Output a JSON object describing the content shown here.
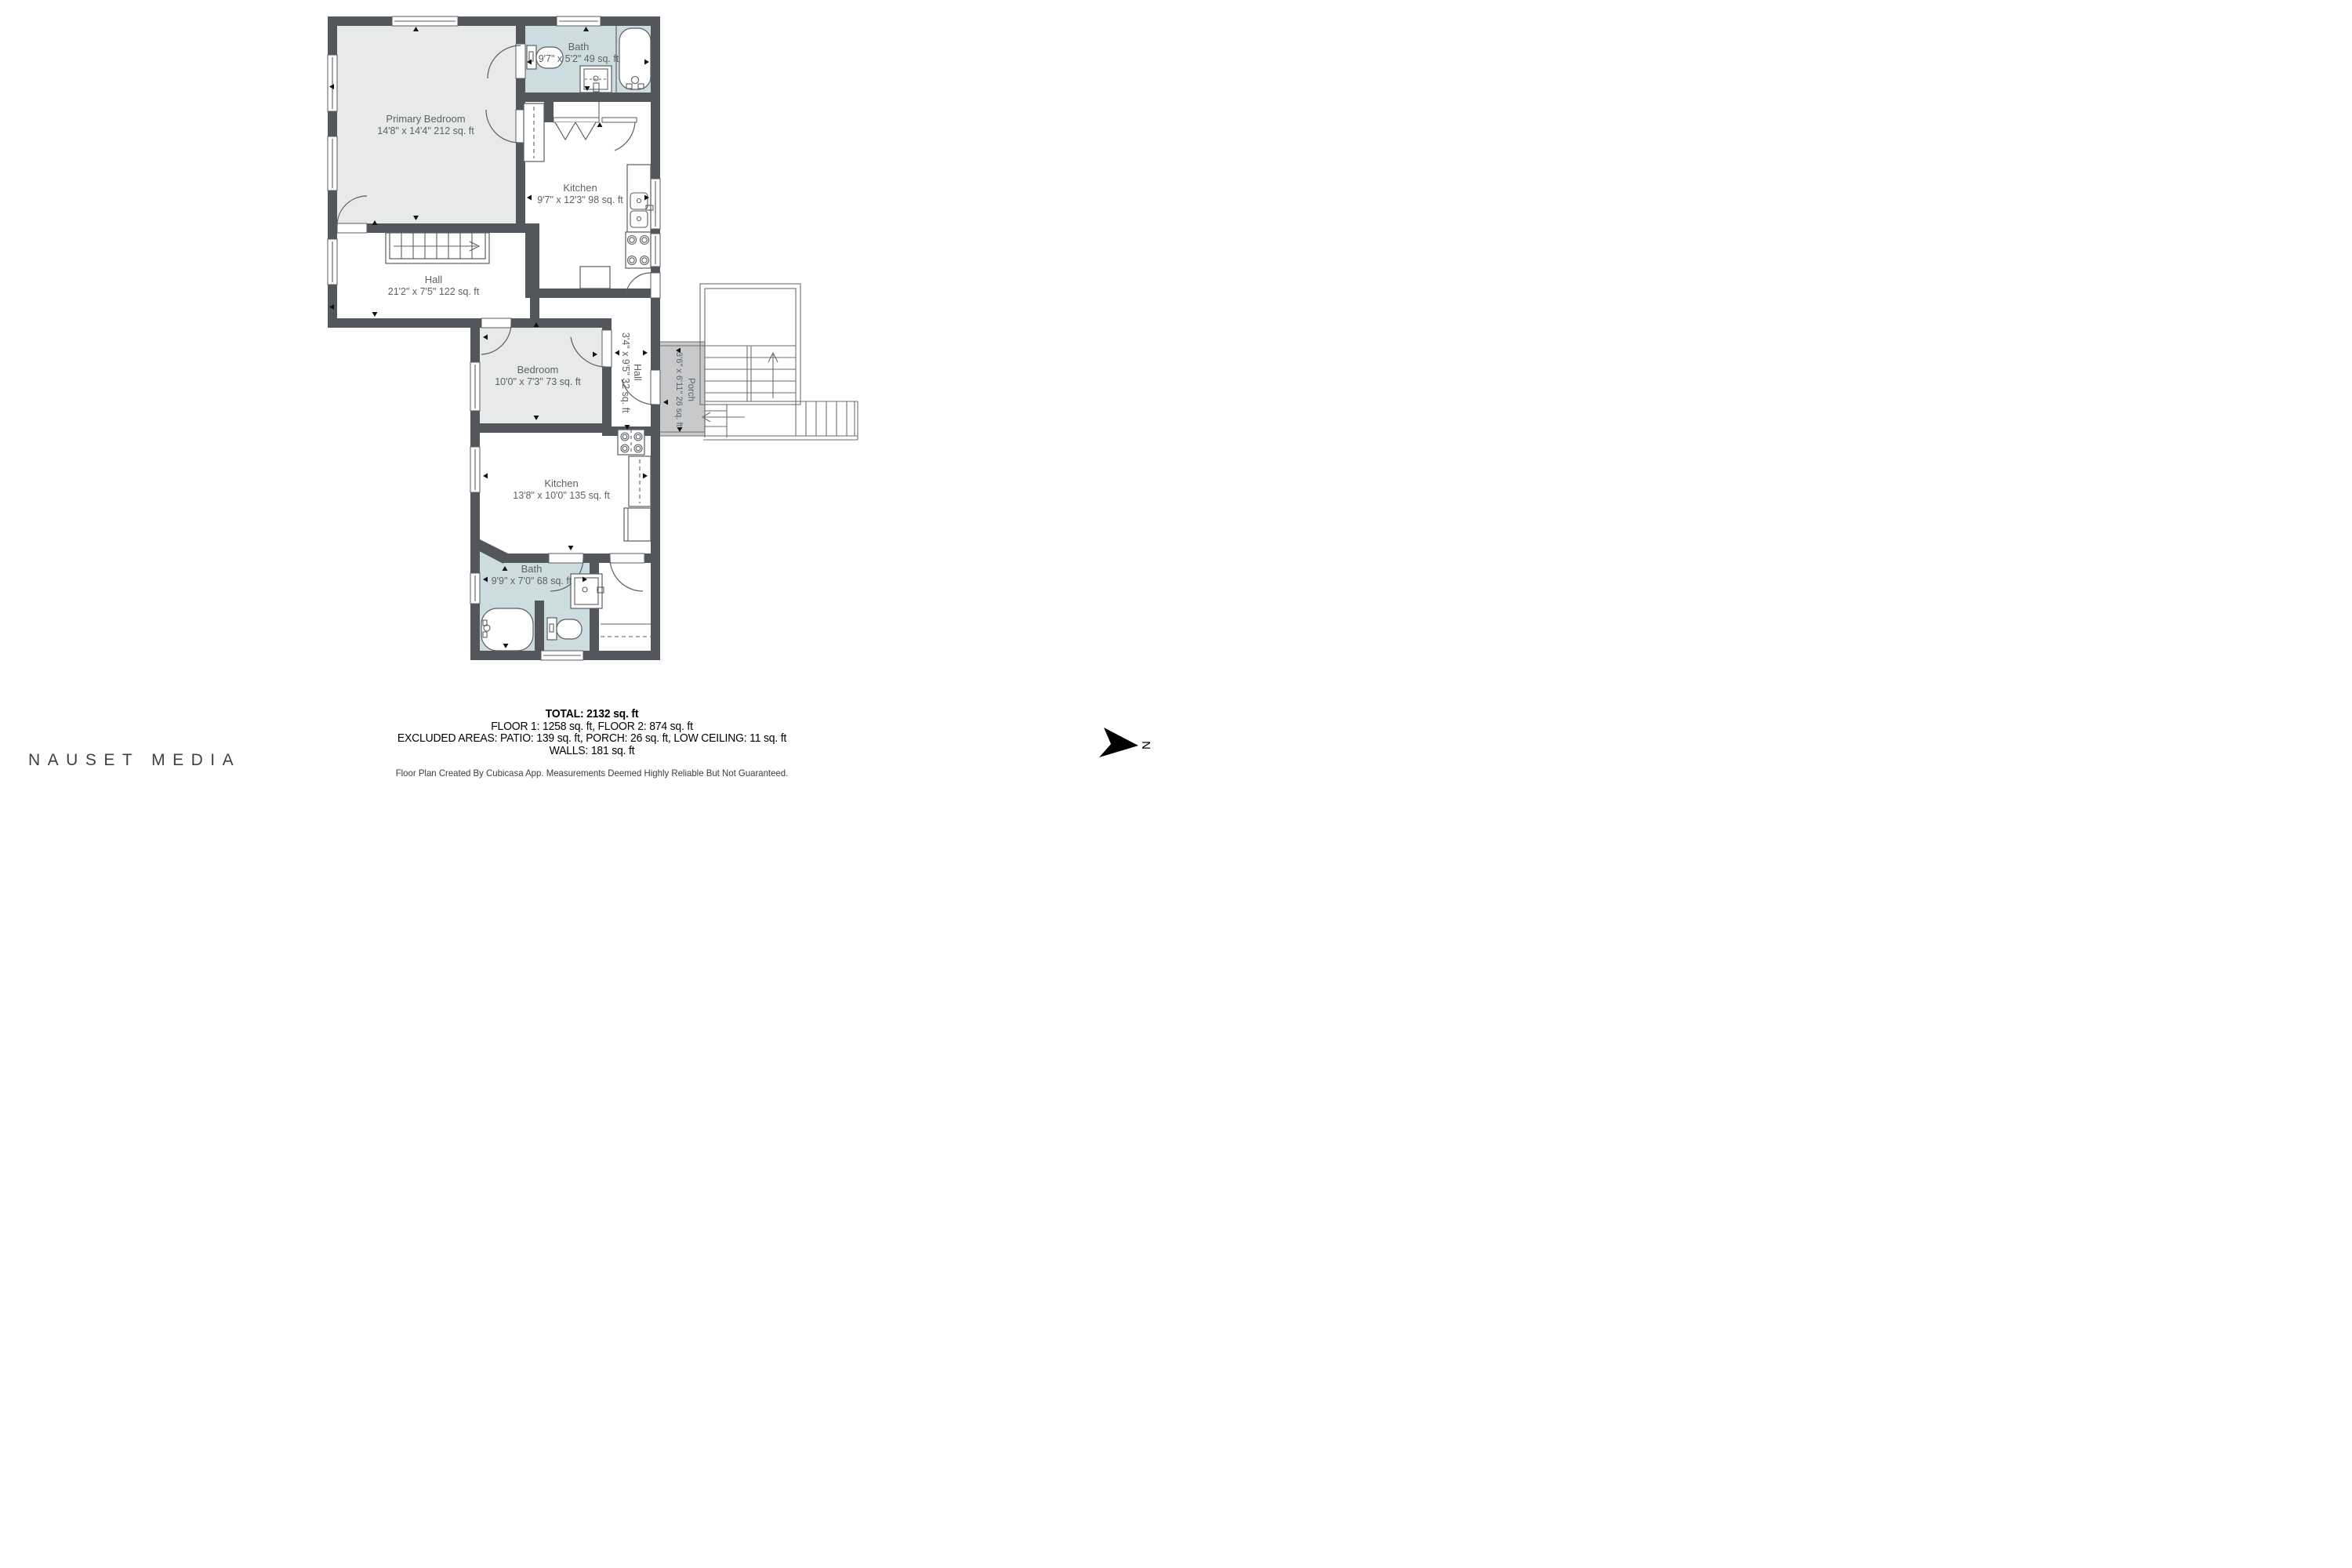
{
  "floorplan": {
    "rooms": {
      "bath2": {
        "name": "Bath",
        "dims": "9'7\" x 5'2\" 49 sq. ft"
      },
      "primary_bedroom": {
        "name": "Primary Bedroom",
        "dims": "14'8\" x 14'4\" 212 sq. ft"
      },
      "kitchen2": {
        "name": "Kitchen",
        "dims": "9'7\" x 12'3\" 98 sq. ft"
      },
      "hall2": {
        "name": "Hall",
        "dims": "21'2\" x 7'5\" 122 sq. ft"
      },
      "bedroom1": {
        "name": "Bedroom",
        "dims": "10'0\" x 7'3\" 73 sq. ft"
      },
      "hall1": {
        "name": "Hall",
        "dims": "3'4\" x 9'5\" 32 sq. ft"
      },
      "porch": {
        "name": "Porch",
        "dims": "3'6\" x 6'11\" 26 sq. ft"
      },
      "kitchen1": {
        "name": "Kitchen",
        "dims": "13'8\" x 10'0\" 135 sq. ft"
      },
      "bath1": {
        "name": "Bath",
        "dims": "9'9\" x 7'0\" 68 sq. ft"
      }
    },
    "colors": {
      "wall": "#53565a",
      "room": "#e8e9e9",
      "bath": "#ccdce0",
      "porch": "#c8c9ca",
      "line": "#5a5d61"
    }
  },
  "summary": {
    "total": "TOTAL: 2132 sq. ft",
    "floors": "FLOOR 1: 1258 sq. ft, FLOOR 2: 874 sq. ft",
    "excluded": "EXCLUDED AREAS: PATIO: 139 sq. ft, PORCH: 26 sq. ft, LOW CEILING: 11 sq. ft",
    "walls": "WALLS: 181 sq. ft",
    "disclaimer": "Floor Plan Created By Cubicasa App. Measurements Deemed Highly Reliable But Not Guaranteed."
  },
  "branding": {
    "logo": "NAUSET MEDIA"
  },
  "compass": {
    "label": "N"
  }
}
